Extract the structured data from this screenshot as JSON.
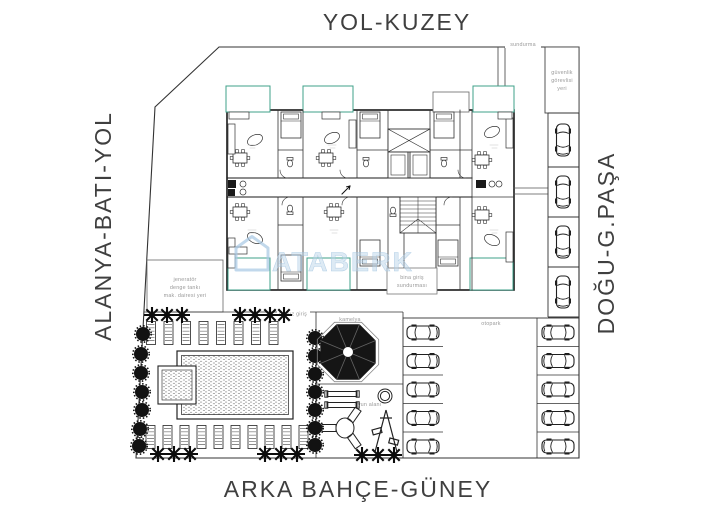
{
  "streets": {
    "north": "YOL-KUZEY",
    "west": "ALANYA-BATI-YOL",
    "east": "DOĞU-G.PAŞA",
    "south": "ARKA BAHÇE-GÜNEY"
  },
  "site_labels": {
    "canopy": "sundurma",
    "security1": "güvenlik",
    "security2": "görevlisi",
    "security3": "yeri",
    "generator1": "jeneratör",
    "generator2": "denge tankı",
    "generator3": "mak. dairesi yeri",
    "pool_entrance": "havuz giriş",
    "gazebo": "kamelya",
    "playground": "oyun alanı",
    "parking": "otopark",
    "entrance1": "bina giriş",
    "entrance2": "sundurması"
  },
  "watermark": {
    "text": "ATABERK"
  },
  "colors": {
    "balcony_green": "#3fa08a",
    "watermark_blue": "#b9d4e9",
    "ink": "#1f1f1f",
    "label_gray": "#9a9a9a",
    "street_text": "#3f3f3f"
  },
  "inventory": {
    "right_strip_cars": 4,
    "lot_left_cars": 5,
    "lot_right_cars": 5,
    "sunbeds_top": 8,
    "sunbeds_bottom": 10
  }
}
